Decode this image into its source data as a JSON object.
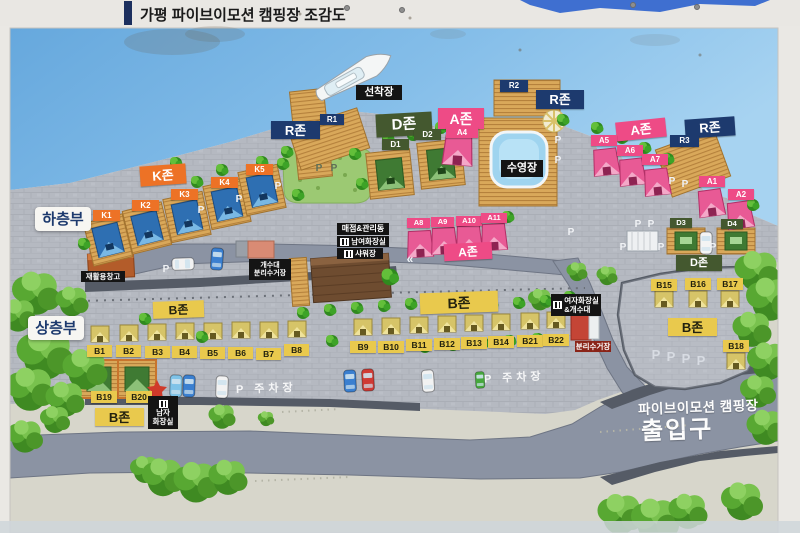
{
  "title": "가평 파이브이모션 캠핑장 조감도",
  "sections": {
    "lower": "하층부",
    "upper": "상층부"
  },
  "zones": {
    "k": "K존",
    "r": "R존",
    "a": "A존",
    "b": "B존",
    "d": "D존"
  },
  "sites": {
    "k": [
      "K1",
      "K2",
      "K3",
      "K4",
      "K5"
    ],
    "r": [
      "R1",
      "R2",
      "R3"
    ],
    "a": [
      "A1",
      "A2",
      "A4",
      "A5",
      "A6",
      "A7",
      "A8",
      "A9",
      "A10",
      "A11"
    ],
    "b": [
      "B1",
      "B2",
      "B3",
      "B4",
      "B5",
      "B6",
      "B7",
      "B8",
      "B9",
      "B10",
      "B11",
      "B12",
      "B13",
      "B14",
      "B15",
      "B16",
      "B17",
      "B18",
      "B19",
      "B20",
      "B21",
      "B22"
    ],
    "d": [
      "D1",
      "D2",
      "D3",
      "D4"
    ]
  },
  "facilities": {
    "dock": "선착장",
    "pool": "수영장",
    "store": "매점&관리동",
    "unisex_toilet": "남여화장실",
    "shower": "샤워장",
    "recycle_storage": "재활용창고",
    "sink": "개수대",
    "recycle_station": "분리수거장",
    "women_toilet": "여자화장실",
    "women_toilet_sub": "&개수대",
    "men_toilet_top": "남자",
    "men_toilet_bottom": "화장실",
    "recycle_small": "분리수거장"
  },
  "entrance": {
    "line1": "파이브이모션 캠핑장",
    "line2": "출입구"
  },
  "legend": {
    "parking": "P",
    "parking_lot": "P 주차장",
    "chevron": "«"
  },
  "colors": {
    "zone_k": "#ed7226",
    "zone_r": "#1d3a6e",
    "zone_a": "#ee4b86",
    "zone_b": "#e9c94d",
    "zone_d": "#44582f",
    "water": "#79b6e6",
    "land": "#b5b9c1",
    "road": "#8b93a3",
    "deck": "#d9a85a",
    "label_black": "#141414"
  }
}
